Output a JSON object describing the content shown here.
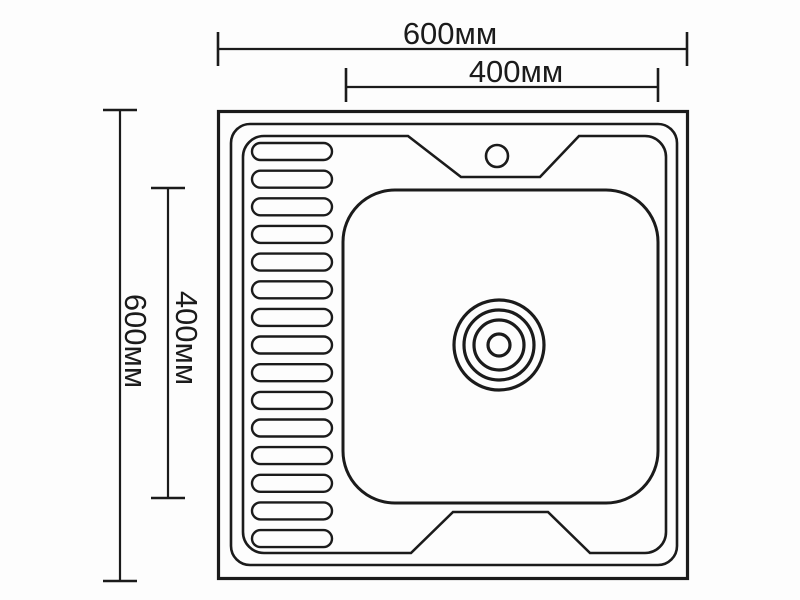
{
  "figure": {
    "type": "technical-drawing",
    "subject": "kitchen sink top view schematic",
    "background_color": "#fdfdfd",
    "line_color": "#1b1b1b"
  },
  "dimensions": {
    "overall_width_label": "600мм",
    "overall_height_label": "600мм",
    "bowl_width_label": "400мм",
    "bowl_height_label": "400мм"
  },
  "drainboard": {
    "ridge_count": 15
  },
  "drain": {
    "ring_radii": [
      45,
      35,
      25,
      11
    ]
  },
  "faucet_hole": {
    "radius": 11
  }
}
